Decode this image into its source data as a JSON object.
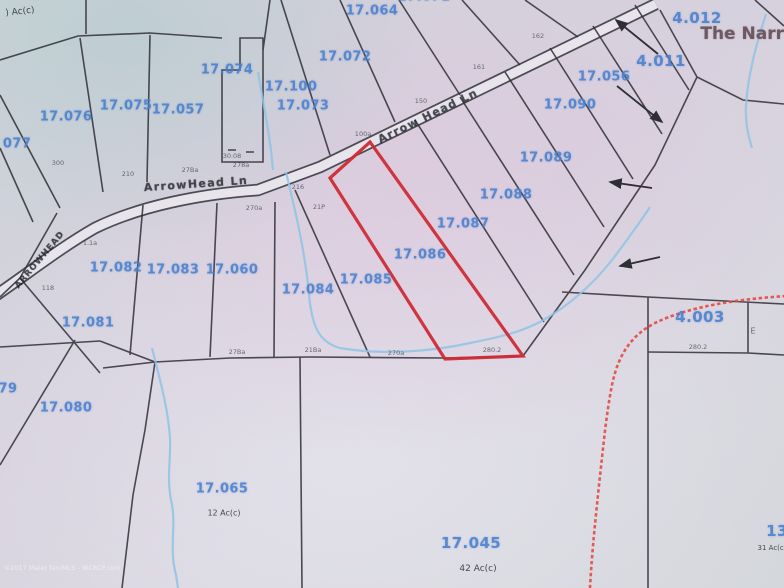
{
  "map": {
    "type": "tax-parcel-map-photo",
    "highlighted_parcel": "17.086",
    "area_name": "The Narro",
    "road_names": [
      "ArrowHead Ln",
      "Arrow Head Ln",
      "ARROWHEAD"
    ],
    "colors": {
      "parcel_label_blue": "#4b80cd",
      "highlight_red": "#cf2b35",
      "trail_dashed_red": "#e34a44",
      "stream_blue": "#8fc3e4",
      "boundary_black": "#2f2e37"
    },
    "watermark": "©2017 Maler fan/MLS - WCRCP.com",
    "labels": [
      {
        "t": ") Ac(c)",
        "x": 20,
        "y": 12,
        "cls": "ac",
        "r": -6
      },
      {
        "t": "17.064",
        "x": 372,
        "y": 11,
        "cls": "p"
      },
      {
        "t": "17.071",
        "x": 424,
        "y": -3,
        "cls": "p"
      },
      {
        "t": "17.072",
        "x": 345,
        "y": 57,
        "cls": "p"
      },
      {
        "t": "17.074",
        "x": 227,
        "y": 70,
        "cls": "p"
      },
      {
        "t": "17.100",
        "x": 291,
        "y": 87,
        "cls": "p"
      },
      {
        "t": "17.073",
        "x": 303,
        "y": 106,
        "cls": "p"
      },
      {
        "t": "17.075",
        "x": 126,
        "y": 106,
        "cls": "p"
      },
      {
        "t": "17.057",
        "x": 178,
        "y": 110,
        "cls": "p"
      },
      {
        "t": "17.076",
        "x": 66,
        "y": 117,
        "cls": "p"
      },
      {
        "t": "077",
        "x": 17,
        "y": 144,
        "cls": "p"
      },
      {
        "t": "4.012",
        "x": 697,
        "y": 18,
        "cls": "pl"
      },
      {
        "t": "The Narro",
        "x": 748,
        "y": 34,
        "cls": "title"
      },
      {
        "t": "4.011",
        "x": 661,
        "y": 61,
        "cls": "pl"
      },
      {
        "t": "17.056",
        "x": 604,
        "y": 77,
        "cls": "p"
      },
      {
        "t": "17.090",
        "x": 570,
        "y": 105,
        "cls": "p"
      },
      {
        "t": "17.089",
        "x": 546,
        "y": 158,
        "cls": "p"
      },
      {
        "t": "17.088",
        "x": 506,
        "y": 195,
        "cls": "p"
      },
      {
        "t": "17.087",
        "x": 463,
        "y": 224,
        "cls": "p"
      },
      {
        "t": "17.086",
        "x": 420,
        "y": 255,
        "cls": "p"
      },
      {
        "t": "17.085",
        "x": 366,
        "y": 280,
        "cls": "p"
      },
      {
        "t": "17.084",
        "x": 308,
        "y": 290,
        "cls": "p"
      },
      {
        "t": "17.082",
        "x": 116,
        "y": 268,
        "cls": "p"
      },
      {
        "t": "17.083",
        "x": 173,
        "y": 270,
        "cls": "p"
      },
      {
        "t": "17.060",
        "x": 232,
        "y": 270,
        "cls": "p"
      },
      {
        "t": "17.081",
        "x": 88,
        "y": 323,
        "cls": "p"
      },
      {
        "t": "79",
        "x": 8,
        "y": 389,
        "cls": "p"
      },
      {
        "t": "17.080",
        "x": 66,
        "y": 408,
        "cls": "p"
      },
      {
        "t": "17.065",
        "x": 222,
        "y": 489,
        "cls": "p"
      },
      {
        "t": "12 Ac(c)",
        "x": 224,
        "y": 513,
        "cls": "ac",
        "fs": 8
      },
      {
        "t": "17.045",
        "x": 471,
        "y": 543,
        "cls": "pl"
      },
      {
        "t": "42 Ac(c)",
        "x": 478,
        "y": 569,
        "cls": "ac"
      },
      {
        "t": "4.003",
        "x": 700,
        "y": 317,
        "cls": "pl"
      },
      {
        "t": "13",
        "x": 777,
        "y": 531,
        "cls": "pl"
      },
      {
        "t": "31 Ac(c)",
        "x": 772,
        "y": 548,
        "cls": "ac",
        "fs": 7
      },
      {
        "t": "E",
        "x": 753,
        "y": 331,
        "cls": "dim",
        "fs": 8
      },
      {
        "t": "ArrowHead Ln",
        "x": 196,
        "y": 184,
        "cls": "road",
        "r": -4,
        "name": "road-label-arrowhead-ln"
      },
      {
        "t": "Arrow Head Ln",
        "x": 428,
        "y": 116,
        "cls": "road",
        "r": -26,
        "name": "road-label-arrow-head-ln"
      },
      {
        "t": "ARROWHEAD",
        "x": 40,
        "y": 260,
        "cls": "road2",
        "r": -50,
        "name": "road-label-arrowhead"
      },
      {
        "t": "300",
        "x": 58,
        "y": 163,
        "cls": "dim"
      },
      {
        "t": "210",
        "x": 128,
        "y": 174,
        "cls": "dim"
      },
      {
        "t": "27Ba",
        "x": 190,
        "y": 170,
        "cls": "dim"
      },
      {
        "t": "278a",
        "x": 241,
        "y": 165,
        "cls": "dim"
      },
      {
        "t": "216",
        "x": 298,
        "y": 187,
        "cls": "dim"
      },
      {
        "t": "270a",
        "x": 254,
        "y": 208,
        "cls": "dim"
      },
      {
        "t": "21P",
        "x": 319,
        "y": 207,
        "cls": "dim"
      },
      {
        "t": "100a",
        "x": 363,
        "y": 134,
        "cls": "dim"
      },
      {
        "t": "150",
        "x": 421,
        "y": 101,
        "cls": "dim"
      },
      {
        "t": "161",
        "x": 479,
        "y": 67,
        "cls": "dim"
      },
      {
        "t": "162",
        "x": 538,
        "y": 36,
        "cls": "dim"
      },
      {
        "t": "30.08",
        "x": 232,
        "y": 156,
        "cls": "dim"
      },
      {
        "t": "1.1a",
        "x": 90,
        "y": 243,
        "cls": "dim"
      },
      {
        "t": "118",
        "x": 48,
        "y": 288,
        "cls": "dim"
      },
      {
        "t": "27Ba",
        "x": 237,
        "y": 352,
        "cls": "dim"
      },
      {
        "t": "21Ba",
        "x": 313,
        "y": 350,
        "cls": "dim"
      },
      {
        "t": "270a",
        "x": 396,
        "y": 353,
        "cls": "dim"
      },
      {
        "t": "280.2",
        "x": 492,
        "y": 350,
        "cls": "dim"
      },
      {
        "t": "280.2",
        "x": 698,
        "y": 347,
        "cls": "dim"
      }
    ]
  }
}
